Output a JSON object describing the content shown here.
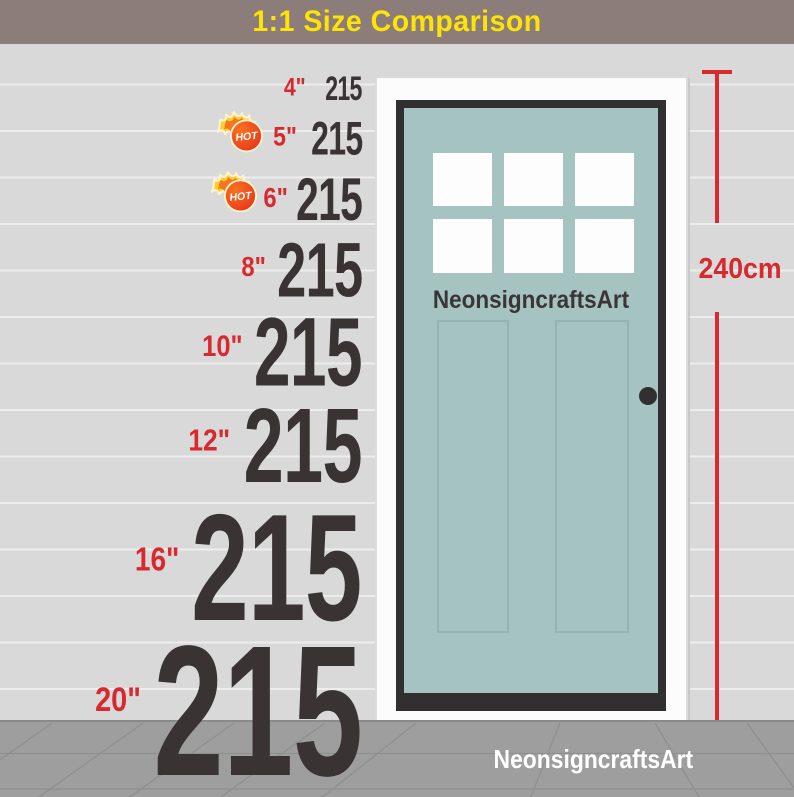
{
  "title_bar": {
    "title": "1:1 Size Comparison"
  },
  "rows": [
    {
      "size": "4\"",
      "value": "215",
      "hot": false
    },
    {
      "size": "5\"",
      "value": "215",
      "hot": true
    },
    {
      "size": "6\"",
      "value": "215",
      "hot": true
    },
    {
      "size": "8\"",
      "value": "215",
      "hot": false
    },
    {
      "size": "10\"",
      "value": "215",
      "hot": false
    },
    {
      "size": "12\"",
      "value": "215",
      "hot": false
    },
    {
      "size": "16\"",
      "value": "215",
      "hot": false
    },
    {
      "size": "20\"",
      "value": "215",
      "hot": false
    }
  ],
  "hot_badge": {
    "label": "HOT"
  },
  "door": {
    "brand": "NeonsigncraftsArt",
    "pane_count": 6
  },
  "measurement": {
    "height_label": "240cm"
  },
  "footer": {
    "watermark": "NeonsigncraftsArt"
  },
  "colors": {
    "title_bg": "#8c7d7a",
    "title_text": "#fee306",
    "label_red": "#d8292f",
    "number_dark": "#393334",
    "door_teal": "#a5c3c0",
    "siding_gray": "#d9d9d9",
    "ground_gray": "#9e9e9e"
  }
}
